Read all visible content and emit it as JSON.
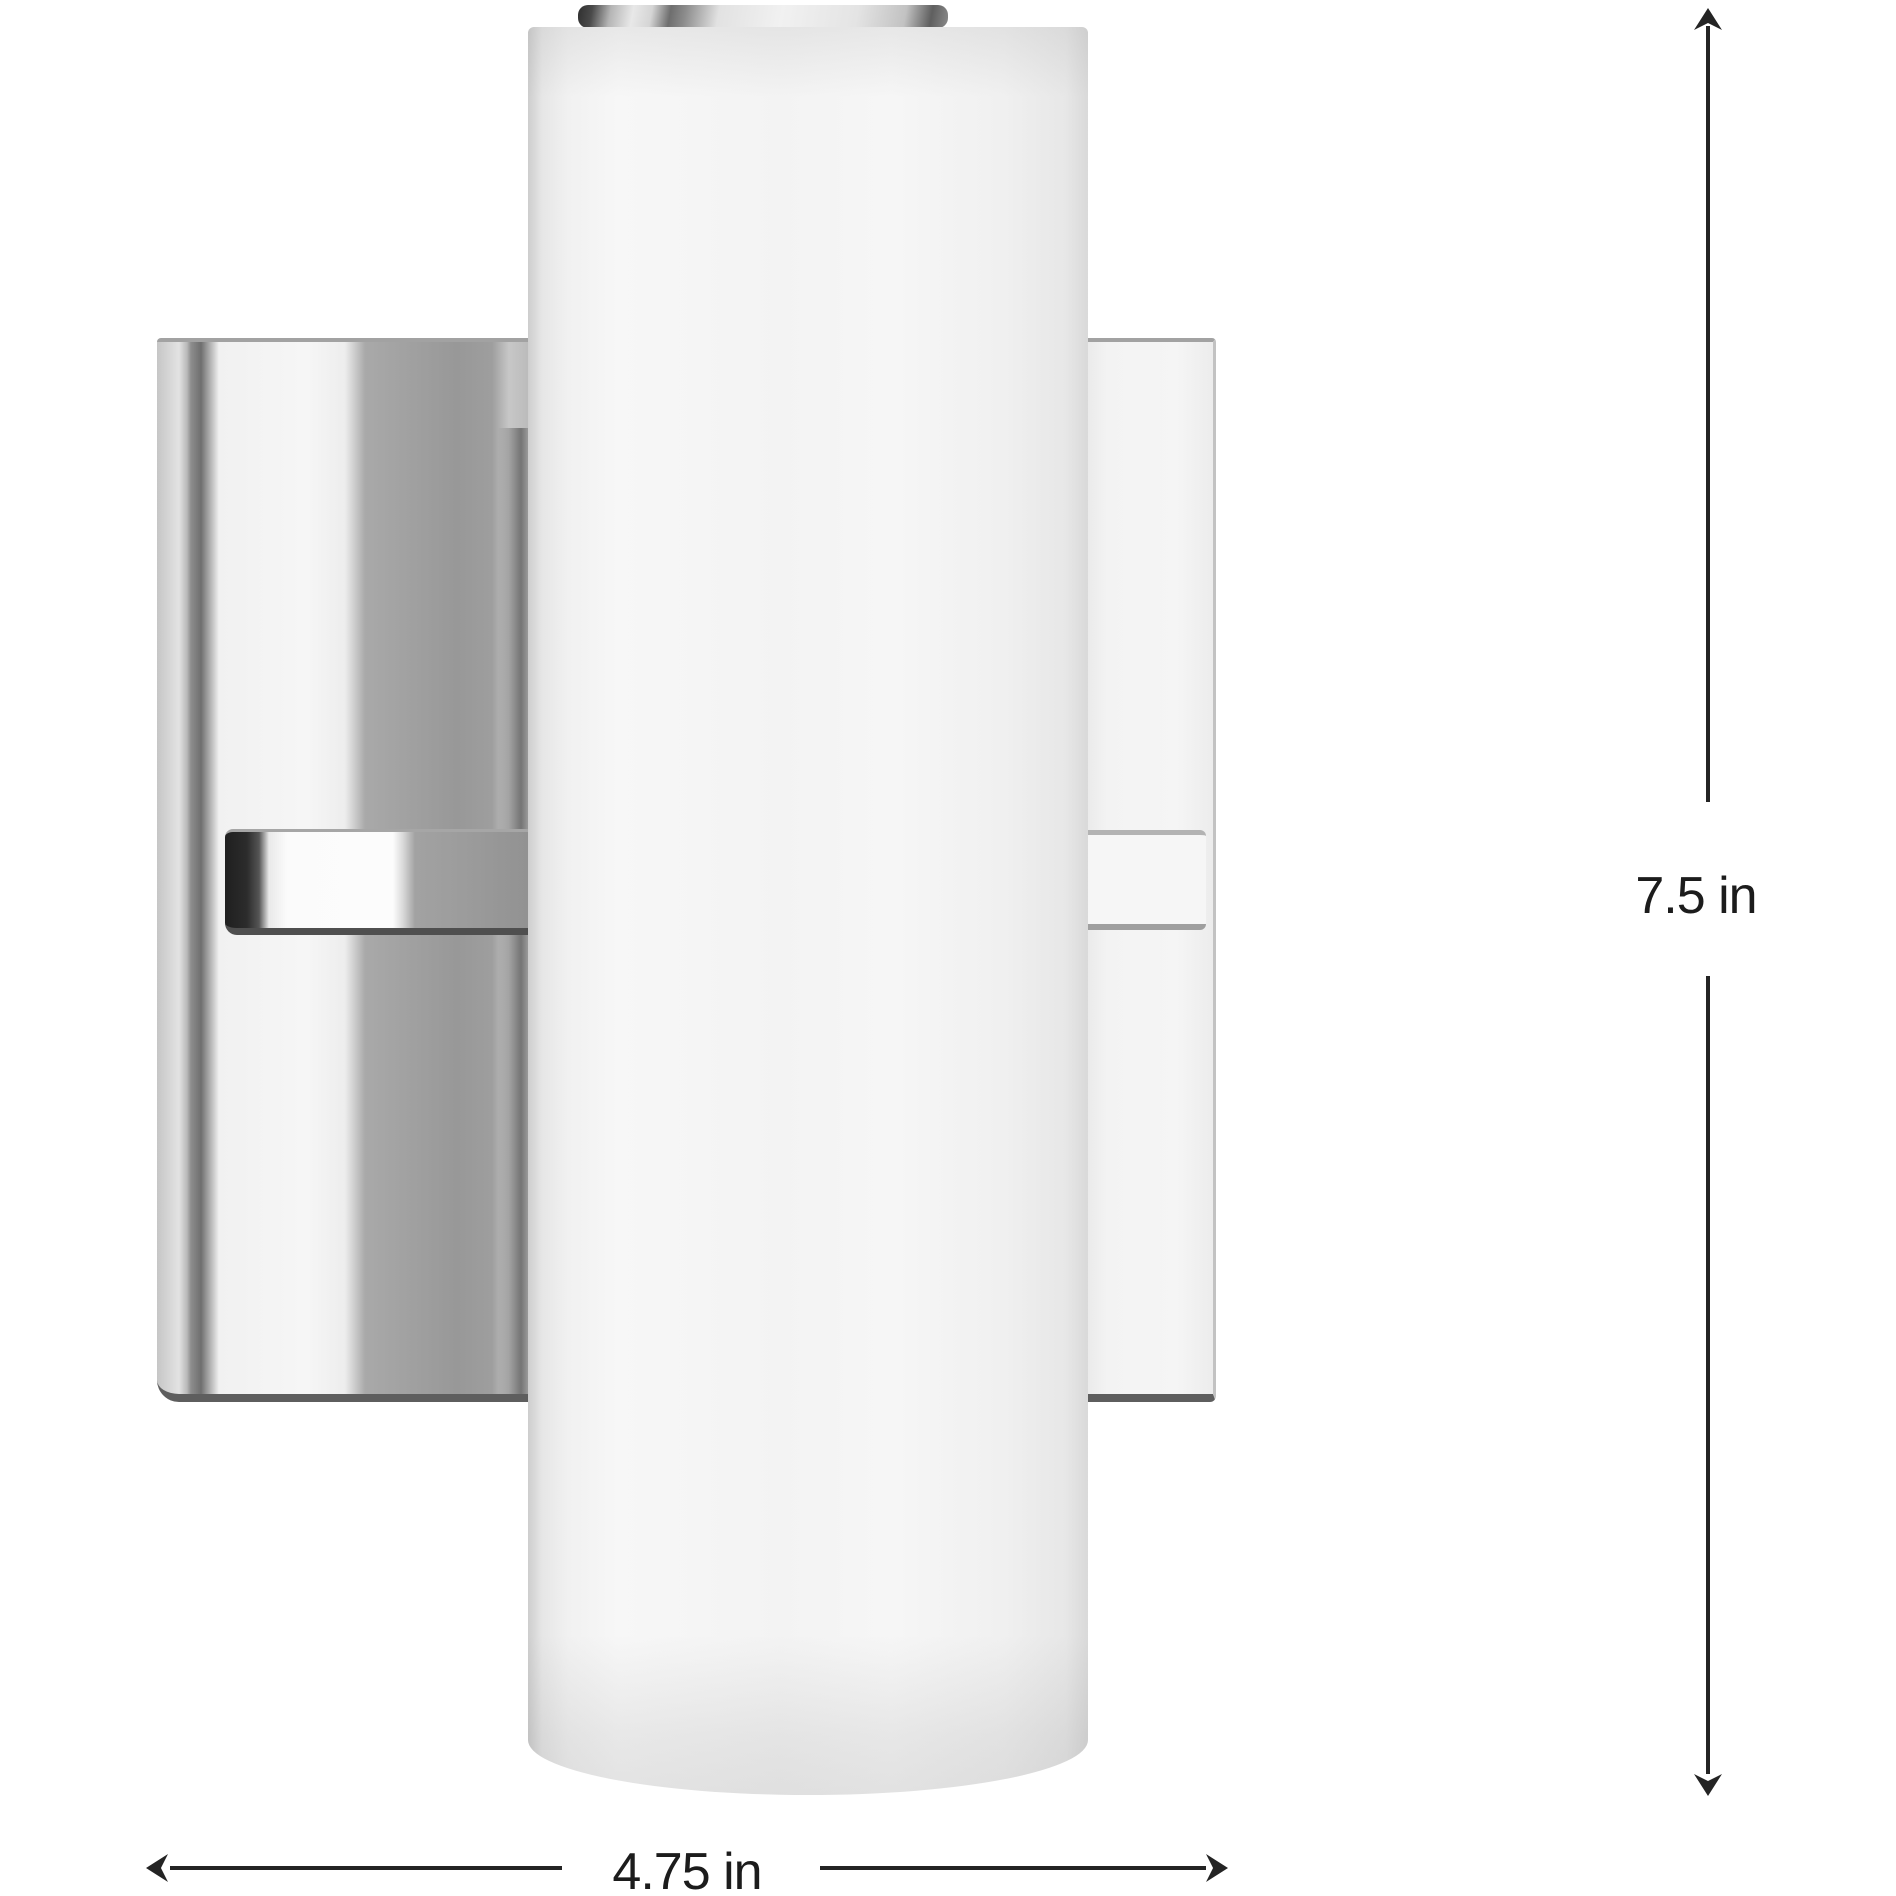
{
  "canvas": {
    "width": 1896,
    "height": 1896,
    "background": "#ffffff"
  },
  "product": {
    "kind": "cylindrical white wall sconce on square polished-chrome backplate"
  },
  "dimensions": {
    "height_label": "7.5 in",
    "width_label": "4.75 in",
    "line_color": "#242424",
    "label_color": "#1c1c1c"
  }
}
